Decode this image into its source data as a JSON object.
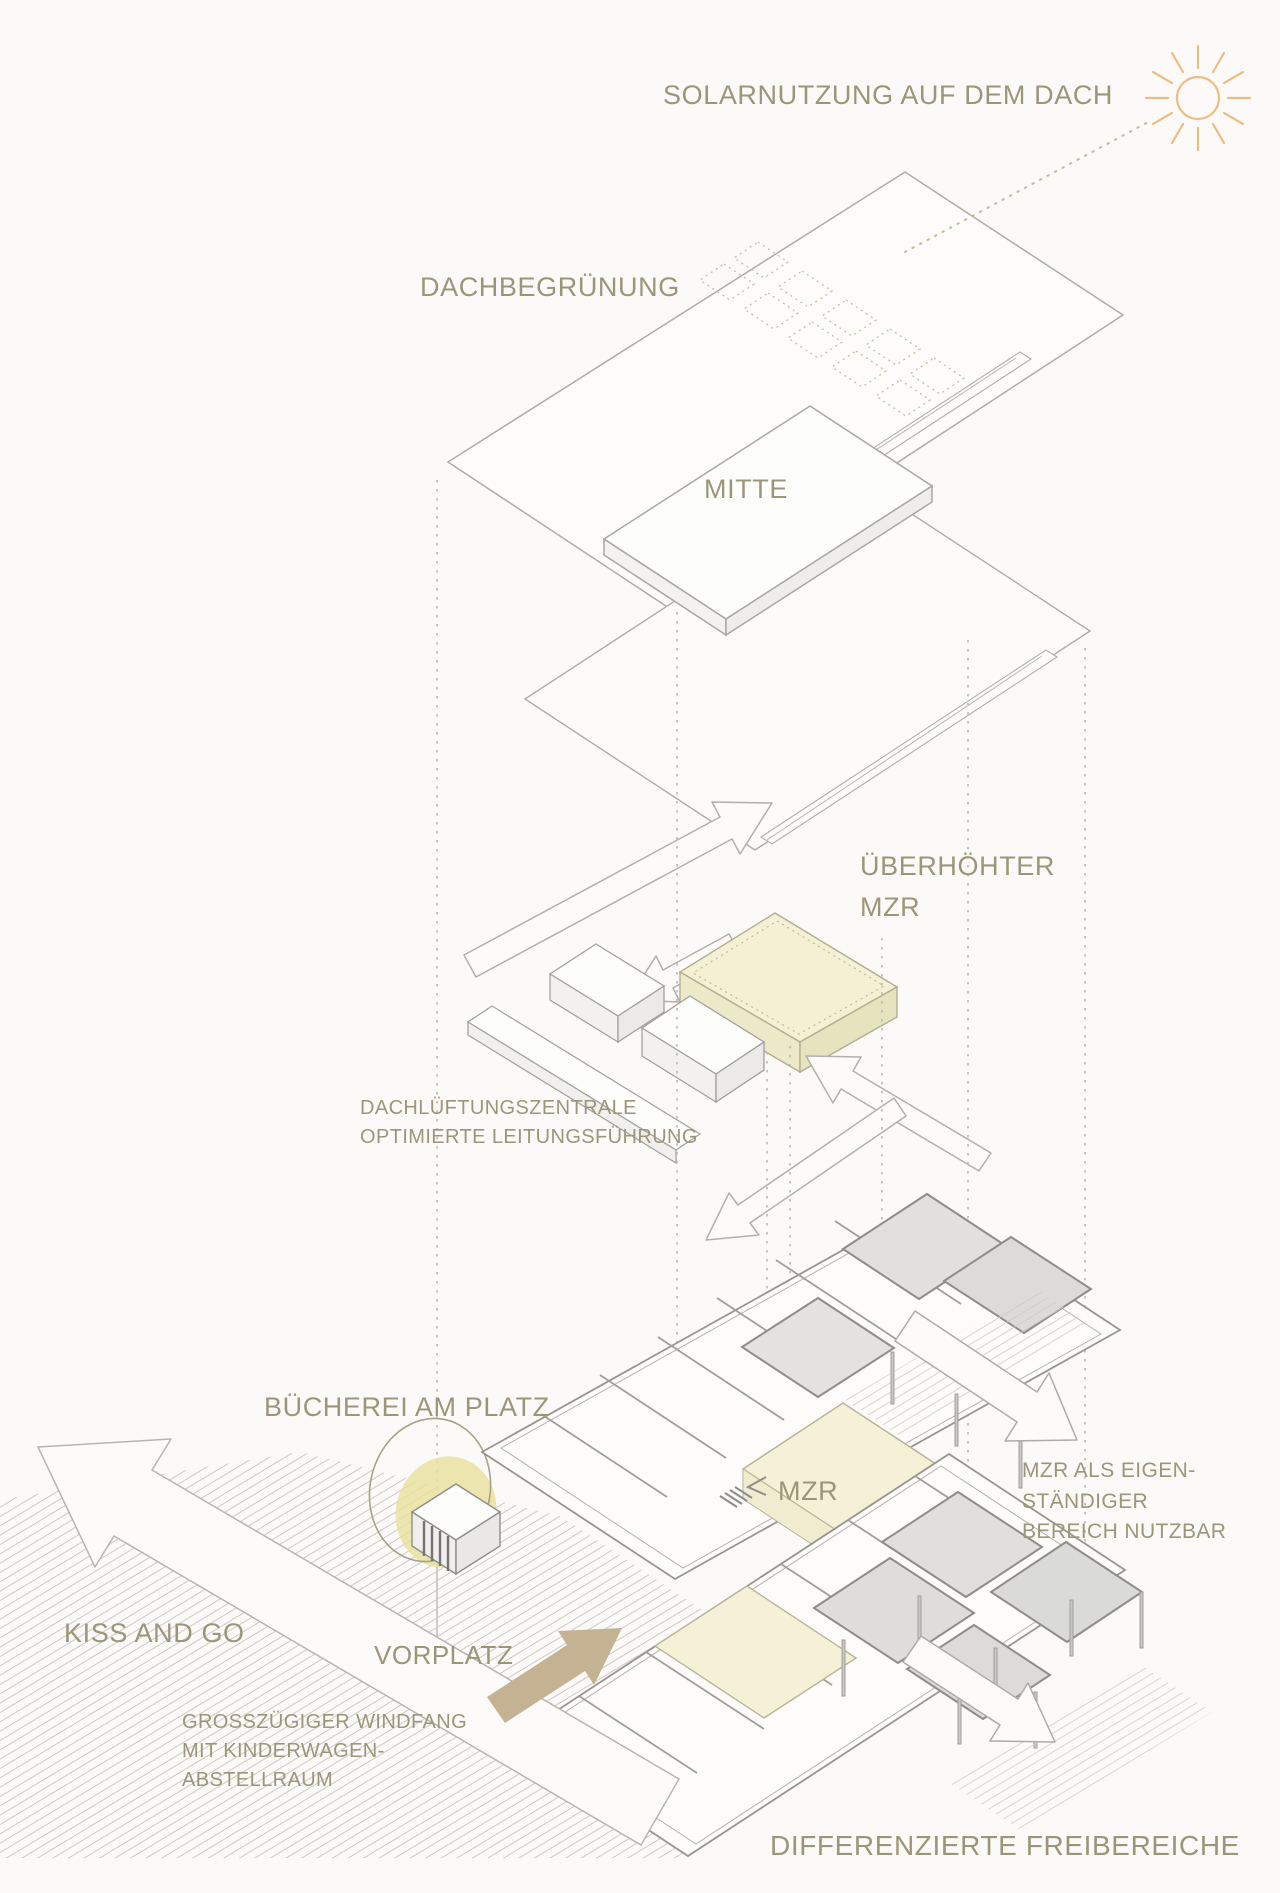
{
  "figure": {
    "kind": "architectural exploded axonometric diagram",
    "language": "German"
  },
  "palette": {
    "background": "#fbfaf8",
    "label_text": "#9c9679",
    "outline_gray": "#aeaca8",
    "wall_gray": "#8f8d89",
    "room_gray": "#dedddc",
    "accent_yellow": "#f4f0d4",
    "highlight_blob": "#e9e19b",
    "sun_orange": "#ecbe83",
    "arrow_tan": "#c4b292",
    "hatch_gray": "#cdcac6",
    "dotted_gray": "#bcb9b4"
  },
  "icons": {
    "sun": "sun-icon",
    "stage_hatch": "stage-icon"
  },
  "labels": {
    "solar_roof": "SOLARNUTZUNG AUF DEM DACH",
    "roof_greening": "DACHBEGRÜNUNG",
    "mitte": "MITTE",
    "mzr_high_line1": "ÜBERHÖHTER",
    "mzr_high_line2": "MZR",
    "vent_line1": "DACHLÜFTUNGSZENTRALE",
    "vent_line2": "OPTIMIERTE LEITUNGSFÜHRUNG",
    "library": "BÜCHEREI AM PLATZ",
    "mzr_floor": "MZR",
    "mzr_note_line1": "MZR ALS EIGEN-",
    "mzr_note_line2": "STÄNDIGER",
    "mzr_note_line3": "BEREICH NUTZBAR",
    "kiss_and_go": "KISS AND GO",
    "vorplatz": "VORPLATZ",
    "windfang_line1": "GROSSZÜGIGER WINDFANG",
    "windfang_line2": "MIT KINDERWAGEN-",
    "windfang_line3": "ABSTELLRAUM",
    "open_spaces": "DIFFERENZIERTE FREIBEREICHE"
  }
}
